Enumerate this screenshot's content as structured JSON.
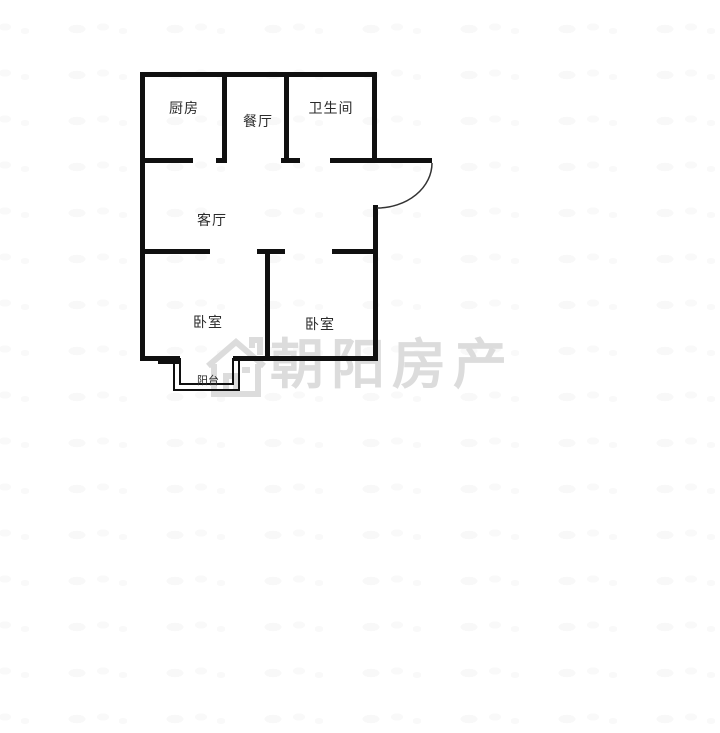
{
  "floorplan": {
    "rooms": {
      "kitchen": {
        "label": "厨房"
      },
      "dining": {
        "label": "餐厅"
      },
      "bathroom": {
        "label": "卫生间"
      },
      "living": {
        "label": "客厅"
      },
      "bedroom_left": {
        "label": "卧室"
      },
      "bedroom_right": {
        "label": "卧室"
      },
      "balcony": {
        "label": "阳台"
      }
    }
  },
  "watermark": {
    "brand": "朝阳房产",
    "logo": "house-icon",
    "color": "#dcdcdc"
  },
  "colors": {
    "wall": "#101010",
    "label": "#2b2b2b",
    "background": "#ffffff",
    "door_arc": "#333333"
  }
}
